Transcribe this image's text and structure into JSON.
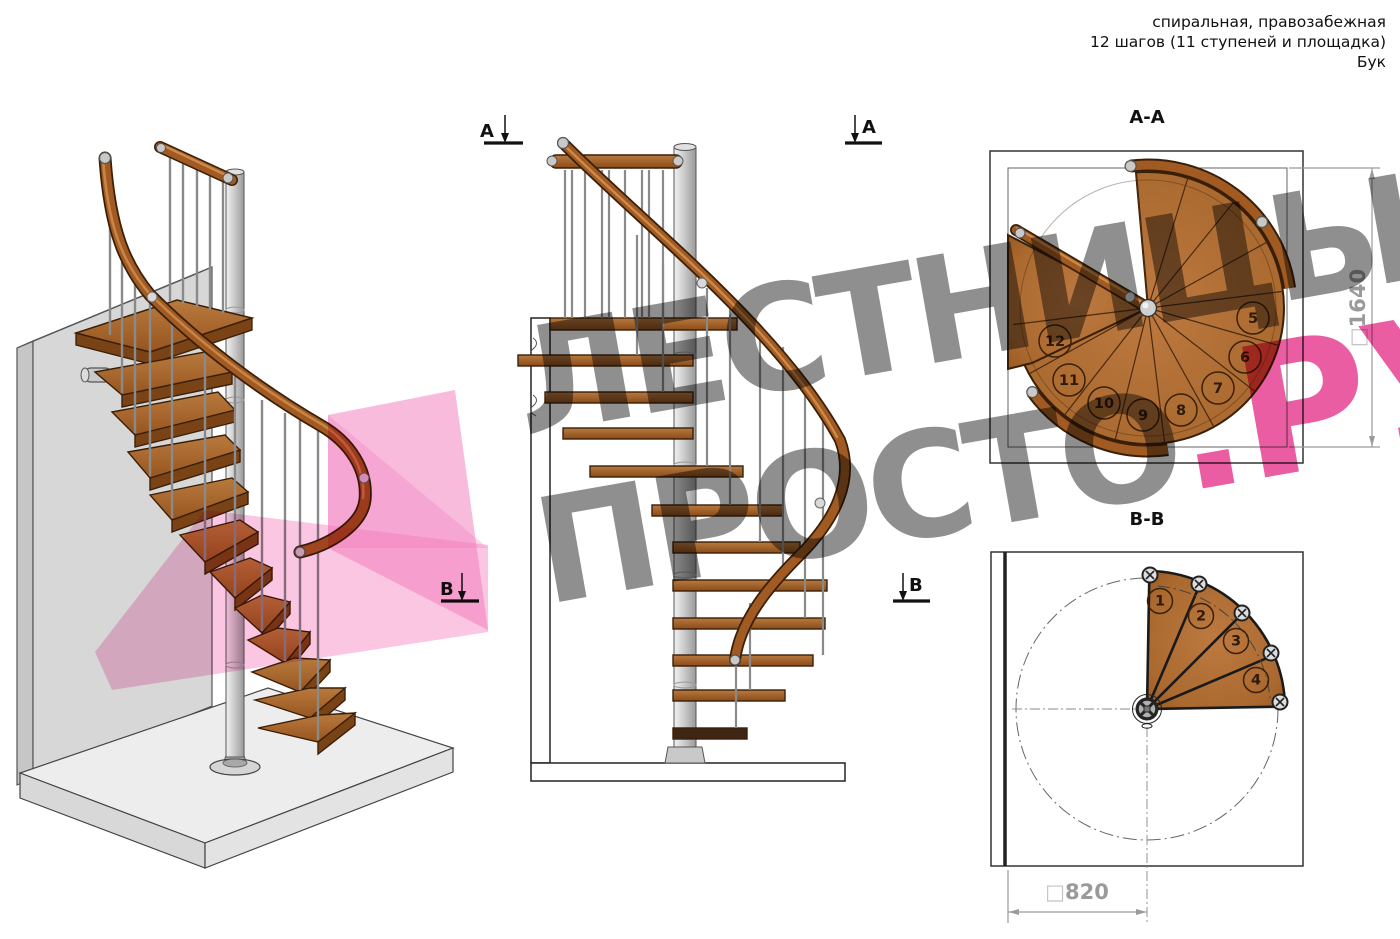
{
  "title_block": {
    "line1": "спиральная, правозабежная",
    "line2": "12 шагов (11 ступеней и площадка)",
    "line3": "Бук"
  },
  "watermark": {
    "line1": "ЛЕСТНИЦЫ",
    "line2": "ПРОСТО",
    "suffix": ".РУ",
    "gray_color": "#8f8f8f",
    "pink_color": "#ea5da2"
  },
  "sections": {
    "aa": {
      "title": "А-А",
      "square": "□",
      "dimension": "1640",
      "step_numbers": [
        "5",
        "6",
        "7",
        "8",
        "9",
        "10",
        "11",
        "12"
      ]
    },
    "bb": {
      "title": "В-В",
      "square": "□",
      "dimension": "820",
      "step_numbers": [
        "1",
        "2",
        "3",
        "4"
      ]
    }
  },
  "markers": {
    "a": "А",
    "b": "В"
  },
  "stair": {
    "total_steps": 12,
    "treads": 11,
    "has_platform": true,
    "material": "Бук"
  },
  "colors": {
    "wood": "#a9692f",
    "wood_dark": "#6b3a10",
    "metal": "#c9c9c9",
    "line": "#1a1a1a",
    "dimension_gray": "#9a9a9a",
    "watermark_pink": "#ea5da2"
  }
}
